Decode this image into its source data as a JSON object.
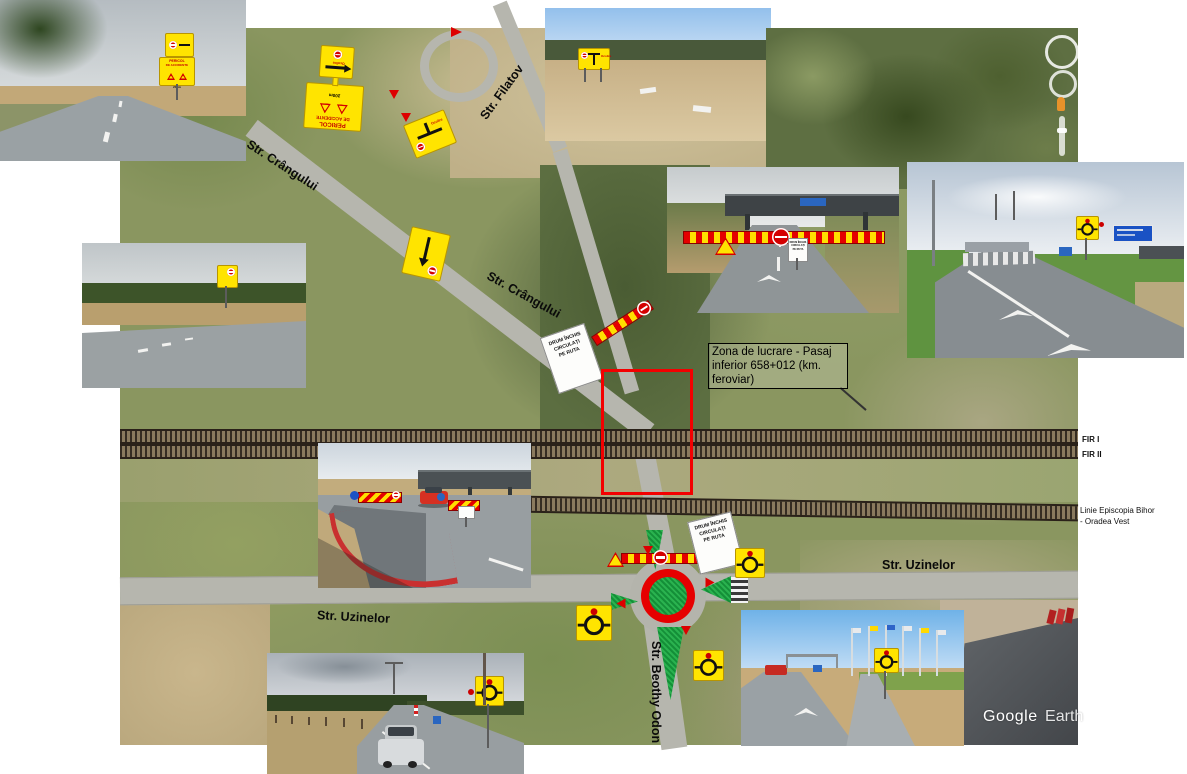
{
  "map": {
    "work_zone_note": "Zona de lucrare - Pasaj inferior 658+012 (km. feroviar)",
    "streets": {
      "crangului": "Str. Crângului",
      "filatov": "Str. Filatov",
      "uzinelor": "Str. Uzinelor",
      "beothy_odon": "Str. Beothy Odon"
    },
    "railway": {
      "fir_1": "FIR I",
      "fir_2": "FIR II",
      "line_line1": "Linie Episcopia Bihor",
      "line_line2": "- Oradea Vest"
    }
  },
  "signs": {
    "pericol_line1": "PERICOL",
    "pericol_line2": "DE ACCIDENTE",
    "pericol_distance": "200m",
    "ocolire_label": "Ocolire",
    "closed_line1": "DRUM ÎNCHIS",
    "closed_line2": "CIRCULAȚI",
    "closed_line3": "PE RUTA"
  },
  "watermark": {
    "google": "Google",
    "earth": "Earth"
  },
  "colors": {
    "work_zone_outline": "#f30000",
    "sign_yellow": "#ffe400",
    "barrier_red": "#e40000",
    "island_green": "#1fa23f",
    "roundabout_ring": "#e60000"
  }
}
